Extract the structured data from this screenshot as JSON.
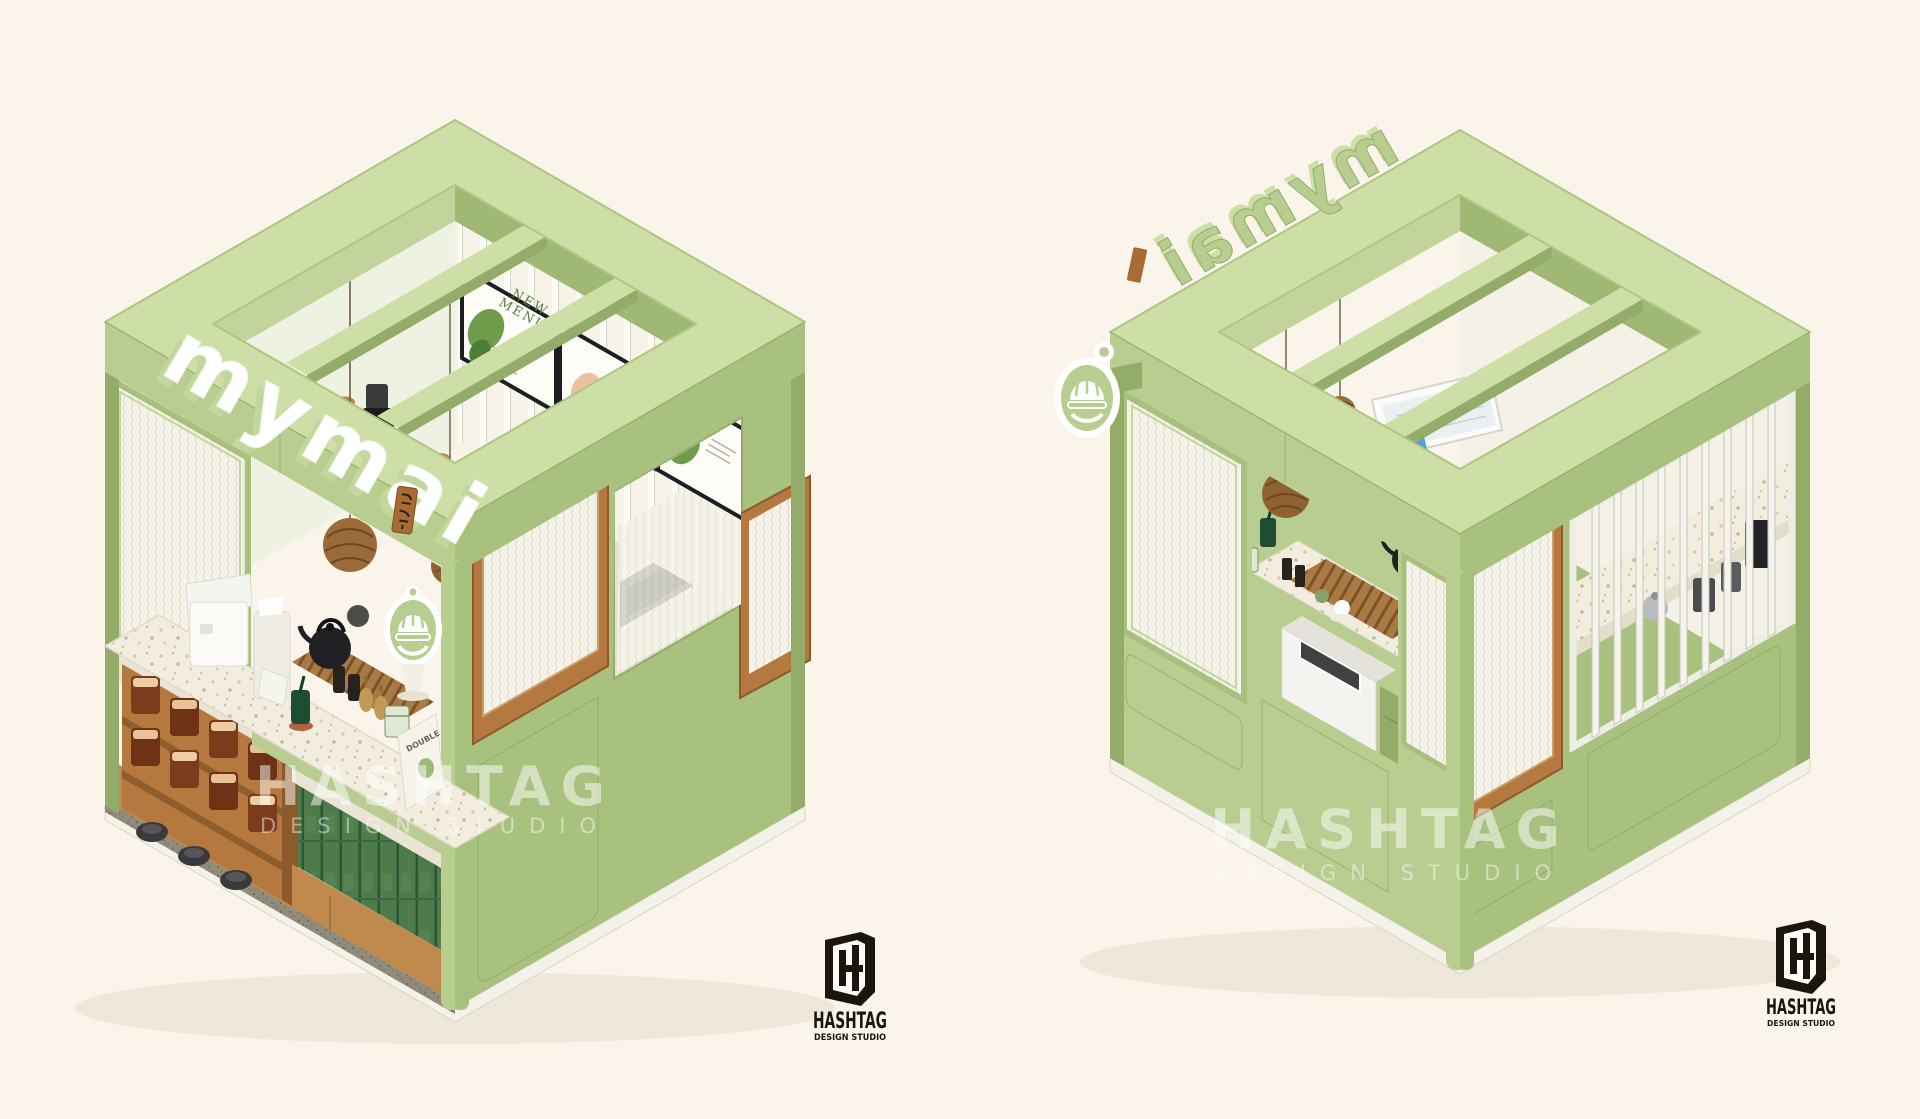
{
  "page": {
    "background": "#FAF4EA"
  },
  "brand": {
    "name": "mymai",
    "tagline_jp": "わまい"
  },
  "left_render": {
    "view_label": "kiosk front isometric view",
    "menu_board": {
      "line1": "NEW",
      "line2": "MENU"
    },
    "book_label": "DOUBLE"
  },
  "right_render": {
    "view_label": "kiosk rear isometric view"
  },
  "watermark": {
    "title": "HASHTAG",
    "subtitle": "DESIGN STUDIO"
  },
  "logo": {
    "title": "HASHTAG",
    "subtitle": "DESIGN STUDIO"
  },
  "colors": {
    "bg": "#FAF4EA",
    "green": "#B7CE90",
    "greenLight": "#CEDEA7",
    "greenShade": "#A9C17F",
    "greenDark": "#93AC69",
    "greenEdge": "#7F9A58",
    "cream": "#F6F2E7",
    "wood": "#B5793F",
    "woodDark": "#8C5A2B",
    "tileGreen": "#4E7B4A",
    "terrazzoBase": "#F2EDDF",
    "steel": "#4A4D4F",
    "black": "#1A1B1D",
    "ink": "#1A160E",
    "jarBrown": "#7A3C1C"
  }
}
